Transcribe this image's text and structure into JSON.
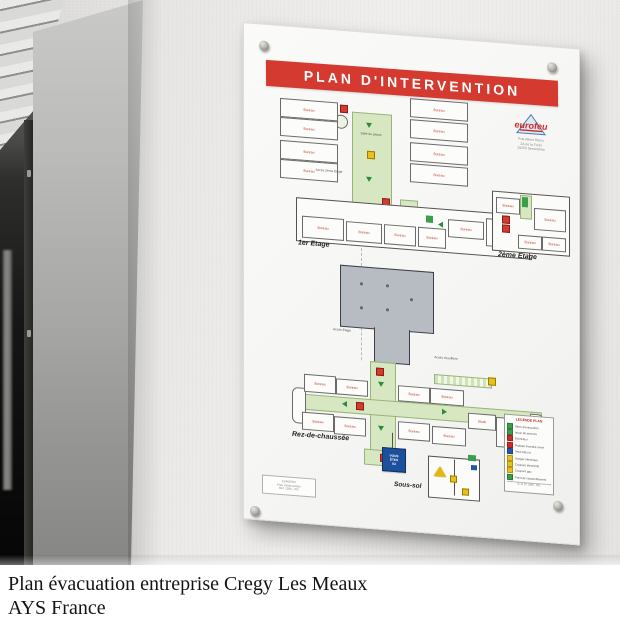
{
  "caption": {
    "line1": "Plan évacuation entreprise Cregy Les Meaux",
    "line2": "AYS France"
  },
  "board": {
    "banner_title": "PLAN D'INTERVENTION",
    "logo": {
      "name": "eurofeu",
      "address_lines": [
        "Rue Albert Remy",
        "ZA de la Forêt",
        "28250 Senonches"
      ]
    },
    "floors": {
      "first": "1er Etage",
      "second": "2ème Etage",
      "ground": "Rez-de-chaussée",
      "basement": "Sous-sol"
    },
    "labels": {
      "access_second_floor": "Accès 2ème Etage",
      "access_floor": "Accès Etage",
      "access_boiler": "Accès chaufferie",
      "break_room": "Salle de pause",
      "you_are_here_lines": [
        "VOUS",
        "ÊTES",
        "ICI"
      ]
    },
    "rooms": {
      "bureau": "Bureau",
      "meeting_room": "Salle de réunion",
      "stock": "Stock"
    },
    "legend": {
      "title": "LEGENDE PLAN",
      "rows": [
        {
          "color": "#3a9e4c",
          "label": "Sens d'évacuation"
        },
        {
          "color": "#3a9e4c",
          "label": "Issue de secours"
        },
        {
          "color": "#cf2a27",
          "label": "Extincteur"
        },
        {
          "color": "#cf2a27",
          "label": "Robinet incendie armé"
        },
        {
          "color": "#2457a8",
          "label": "Vous êtes ici"
        },
        {
          "color": "#e8c11c",
          "label": "Danger électrique"
        },
        {
          "color": "#e8c11c",
          "label": "Coupure électricité"
        },
        {
          "color": "#e8c11c",
          "label": "Coupure gaz"
        },
        {
          "color": "#3a9e4c",
          "label": "Point de rassemblement"
        }
      ],
      "ref": "G 11 07 1396 - 001"
    },
    "plate": {
      "lines": [
        "EUROFEU",
        "Plan d'intervention",
        "Réf. 1396 - 001"
      ]
    },
    "colors": {
      "banner_red": "#d43a2f",
      "corridor_green": "#d7e7c2",
      "gray_block": "#b7bcc2",
      "marker_blue": "#1c4f9c",
      "warning_yellow": "#e8b806",
      "plan_line": "#555555"
    }
  }
}
